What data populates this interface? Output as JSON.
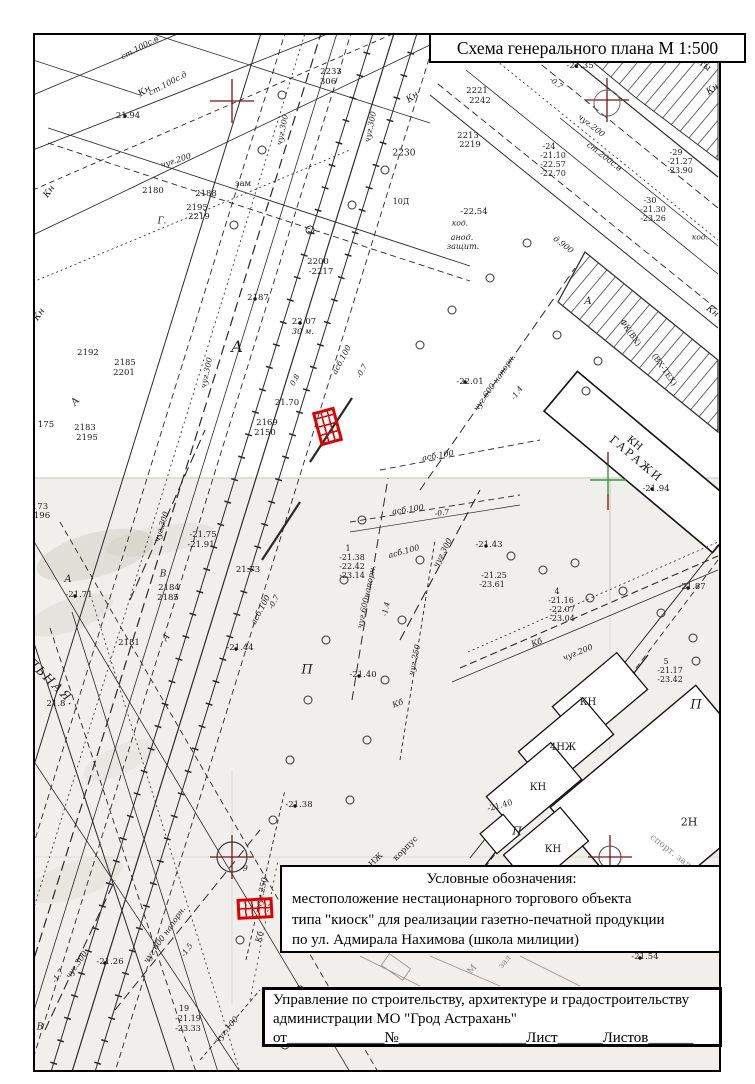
{
  "title_box": {
    "text": "Схема генерального плана М 1:500"
  },
  "legend": {
    "heading": "Условные обозначения:",
    "lines": [
      "местоположение нестационарного торгового объекта",
      "типа \"киоск\" для реализации газетно-печатной продукции",
      "по ул. Адмирала Нахимова (школа милиции)"
    ],
    "symbol": "red-hatched-rectangle"
  },
  "stamp": {
    "line1": "Управление по строительству, архитектуре и градостроительству",
    "line2": "администрации МО \"Грод Астрахань\"",
    "line3": "от_____________№_________________Лист______Листов______"
  },
  "colors": {
    "marker_red": "#e10000",
    "grid_cross_red": "#7d1216",
    "grid_cross_green": "#2f9e38",
    "ink": "#1c1c1c"
  },
  "map": {
    "scale": "М 1:500",
    "labels": [
      [
        "ст.100с.в",
        140,
        48,
        -28,
        8,
        "i"
      ],
      [
        "ст.100с.д",
        168,
        84,
        -28,
        8,
        "i"
      ],
      [
        "Кн",
        145,
        92,
        -32,
        9,
        "i"
      ],
      [
        "21.94",
        128,
        116,
        0,
        8.5,
        ""
      ],
      [
        "чуг.200",
        176,
        161,
        -18,
        8,
        "i"
      ],
      [
        "Кн",
        50,
        192,
        -55,
        9,
        "i"
      ],
      [
        "зам",
        243,
        184,
        0,
        8.5,
        ""
      ],
      [
        "2180",
        153,
        191,
        0,
        8.5,
        ""
      ],
      [
        "2188",
        206,
        194,
        0,
        8.5,
        ""
      ],
      [
        "2195",
        197,
        208,
        0,
        8.5,
        ""
      ],
      [
        "2219",
        199,
        217,
        0,
        8.5,
        ""
      ],
      [
        "Г.",
        162,
        222,
        0,
        9,
        "i"
      ],
      [
        "2192",
        88,
        353,
        0,
        8.5,
        ""
      ],
      [
        "2185",
        125,
        363,
        0,
        8.5,
        ""
      ],
      [
        "2201",
        124,
        373,
        0,
        8.5,
        ""
      ],
      [
        "А",
        76,
        402,
        -50,
        10,
        "i"
      ],
      [
        "чуг.300",
        207,
        373,
        -78,
        8,
        "i"
      ],
      [
        "175",
        46,
        425,
        0,
        8.5,
        ""
      ],
      [
        "2183",
        85,
        428,
        0,
        8.5,
        ""
      ],
      [
        "2195",
        87,
        438,
        0,
        8.5,
        ""
      ],
      [
        "Кн",
        40,
        315,
        -55,
        9,
        "i"
      ],
      [
        "В",
        163,
        575,
        0,
        9,
        "i"
      ],
      [
        "2233",
        331,
        72,
        0,
        8.5,
        ""
      ],
      [
        "306",
        328,
        82,
        0,
        8.5,
        ""
      ],
      [
        "чуг.300",
        283,
        130,
        -78,
        8,
        "i"
      ],
      [
        "чуг.300",
        371,
        127,
        -78,
        8,
        "i"
      ],
      [
        "Кн",
        413,
        98,
        -35,
        9,
        "i"
      ],
      [
        "2221",
        477,
        91,
        0,
        8.5,
        ""
      ],
      [
        "2242",
        480,
        101,
        0,
        8.5,
        ""
      ],
      [
        "2213",
        468,
        136,
        0,
        8.5,
        ""
      ],
      [
        "2219",
        470,
        145,
        0,
        8.5,
        ""
      ],
      [
        "2230",
        404,
        154,
        0,
        9,
        ""
      ],
      [
        "10Д",
        401,
        202,
        0,
        8,
        ""
      ],
      [
        "2200",
        318,
        262,
        0,
        8.5,
        ""
      ],
      [
        "-2217",
        321,
        272,
        0,
        8.5,
        ""
      ],
      [
        "2187",
        258,
        298,
        0,
        8.5,
        ""
      ],
      [
        "22.07",
        304,
        322,
        0,
        8.5,
        ""
      ],
      [
        "30 м.",
        303,
        332,
        0,
        8,
        "i"
      ],
      [
        "А",
        237,
        347,
        0,
        16,
        "i"
      ],
      [
        "0.8",
        295,
        380,
        -62,
        7.5,
        "i"
      ],
      [
        "асб.100",
        342,
        360,
        -62,
        8,
        "i"
      ],
      [
        "-0.7",
        362,
        371,
        -62,
        7.5,
        "i"
      ],
      [
        "21.70",
        287,
        403,
        0,
        8.5,
        ""
      ],
      [
        "2169",
        267,
        423,
        0,
        8.5,
        ""
      ],
      [
        "2150",
        265,
        433,
        0,
        8.5,
        ""
      ],
      [
        "асб.100",
        438,
        456,
        -10,
        8,
        "i"
      ],
      [
        "латы",
        700,
        63,
        38,
        9,
        ""
      ],
      [
        "-21.35",
        580,
        66,
        0,
        8.5,
        ""
      ],
      [
        "-0.7",
        556,
        83,
        38,
        7.5,
        "i"
      ],
      [
        "чуг.200",
        591,
        126,
        38,
        8,
        "i"
      ],
      [
        "ст.200с.в",
        604,
        157,
        38,
        8,
        "i"
      ],
      [
        "-24",
        549,
        147,
        0,
        8,
        ""
      ],
      [
        "-21.10",
        553,
        156,
        0,
        8,
        ""
      ],
      [
        "-22.57",
        553,
        165,
        0,
        8,
        ""
      ],
      [
        "-22.70",
        553,
        174,
        0,
        8,
        ""
      ],
      [
        "-29",
        676,
        153,
        0,
        8,
        ""
      ],
      [
        "-21.27",
        680,
        162,
        0,
        8,
        ""
      ],
      [
        "-23.90",
        680,
        171,
        0,
        8,
        ""
      ],
      [
        "-30",
        650,
        201,
        0,
        8,
        ""
      ],
      [
        "-21.30",
        653,
        210,
        0,
        8,
        ""
      ],
      [
        "-23.26",
        653,
        219,
        0,
        8,
        ""
      ],
      [
        "код.",
        700,
        237,
        0,
        7.5,
        "i"
      ],
      [
        "Кн",
        713,
        90,
        -35,
        9,
        "i"
      ],
      [
        "-22.54",
        474,
        212,
        0,
        8.5,
        ""
      ],
      [
        "код.",
        460,
        223,
        0,
        7.5,
        "i"
      ],
      [
        "анод.",
        462,
        238,
        0,
        8,
        "i"
      ],
      [
        "защит.",
        463,
        247,
        0,
        8,
        "i"
      ],
      [
        "д.900",
        563,
        245,
        38,
        8,
        "i"
      ],
      [
        "А",
        588,
        302,
        0,
        10,
        "i"
      ],
      [
        "Кн",
        712,
        312,
        38,
        9,
        "i"
      ],
      [
        "ФК(ВХ)",
        630,
        333,
        55,
        8,
        ""
      ],
      [
        "(ВХ-ТЕХ)",
        664,
        370,
        55,
        8,
        ""
      ],
      [
        "-22.01",
        470,
        382,
        0,
        8.5,
        ""
      ],
      [
        "чуг.600 напорн.",
        495,
        383,
        -55,
        8,
        "i"
      ],
      [
        "-1.4",
        517,
        393,
        -55,
        7.5,
        "i"
      ],
      [
        "КН",
        634,
        444,
        40,
        10,
        ""
      ],
      [
        "ГАРАЖИ",
        636,
        459,
        40,
        11,
        "ls"
      ],
      [
        "-21.94",
        656,
        489,
        0,
        8.5,
        ""
      ],
      [
        "асб.100",
        408,
        510,
        -8,
        8,
        "i"
      ],
      [
        "-0.7",
        442,
        513,
        -8,
        7.5,
        "i"
      ],
      [
        "173",
        40,
        507,
        0,
        8.5,
        ""
      ],
      [
        "196",
        42,
        516,
        0,
        8.5,
        ""
      ],
      [
        "чуг.300",
        162,
        527,
        -72,
        8,
        "i"
      ],
      [
        "-21.75",
        203,
        535,
        0,
        8.5,
        ""
      ],
      [
        "-21.91",
        201,
        545,
        0,
        8.5,
        ""
      ],
      [
        "21.73",
        248,
        570,
        0,
        8.5,
        ""
      ],
      [
        "А",
        68,
        580,
        0,
        10,
        "i"
      ],
      [
        "-21.71",
        79,
        595,
        0,
        8.5,
        ""
      ],
      [
        "2184",
        169,
        588,
        0,
        8.5,
        ""
      ],
      [
        "2185",
        168,
        598,
        0,
        8.5,
        ""
      ],
      [
        "2181",
        129,
        643,
        0,
        8.5,
        ""
      ],
      [
        "асб.100",
        261,
        610,
        -62,
        8,
        "i"
      ],
      [
        "-0.7",
        274,
        602,
        -62,
        7.5,
        "i"
      ],
      [
        "-21.44",
        240,
        648,
        0,
        8.5,
        ""
      ],
      [
        "А",
        167,
        638,
        -50,
        9,
        "i"
      ],
      [
        "ЛЬНАЯ.",
        52,
        682,
        44,
        12,
        "i ls"
      ],
      [
        "21.8",
        56,
        704,
        0,
        8.5,
        ""
      ],
      [
        "1",
        348,
        549,
        0,
        8,
        ""
      ],
      [
        "-21.38",
        352,
        558,
        0,
        8,
        ""
      ],
      [
        "-22.42",
        352,
        567,
        0,
        8,
        ""
      ],
      [
        "-23.14",
        352,
        576,
        0,
        8,
        ""
      ],
      [
        "асб.100",
        404,
        552,
        -15,
        8,
        "i"
      ],
      [
        "чуг.300",
        443,
        553,
        -62,
        8,
        "i"
      ],
      [
        "-21.43",
        489,
        545,
        0,
        8.5,
        ""
      ],
      [
        "-21.25",
        494,
        576,
        0,
        8,
        ""
      ],
      [
        "-23.61",
        492,
        585,
        0,
        8,
        ""
      ],
      [
        "4",
        557,
        592,
        0,
        8,
        ""
      ],
      [
        "-21.16",
        561,
        601,
        0,
        8,
        ""
      ],
      [
        "-22.07",
        562,
        610,
        0,
        8,
        ""
      ],
      [
        "-23.04",
        562,
        619,
        0,
        8,
        ""
      ],
      [
        "-21.87",
        692,
        587,
        0,
        8.5,
        ""
      ],
      [
        "чуг.600напорн.",
        367,
        597,
        -78,
        8,
        "i"
      ],
      [
        "-1.4",
        386,
        609,
        -78,
        7.5,
        "i"
      ],
      [
        "чуг.250",
        415,
        660,
        -78,
        8,
        "i"
      ],
      [
        "-21.40",
        363,
        675,
        0,
        8.5,
        ""
      ],
      [
        "П",
        307,
        670,
        0,
        13,
        "i"
      ],
      [
        "Кб",
        398,
        704,
        -20,
        8,
        "i"
      ],
      [
        "Кб",
        537,
        643,
        -20,
        8,
        "i"
      ],
      [
        "чуг.200",
        578,
        653,
        -22,
        8,
        "i"
      ],
      [
        "5",
        666,
        662,
        0,
        8,
        ""
      ],
      [
        "-21.17",
        670,
        671,
        0,
        8,
        ""
      ],
      [
        "-23.42",
        670,
        680,
        0,
        8,
        ""
      ],
      [
        "П",
        696,
        705,
        0,
        13,
        "i"
      ],
      [
        "КН",
        588,
        703,
        0,
        10,
        ""
      ],
      [
        "4НЖ",
        563,
        748,
        0,
        10,
        ""
      ],
      [
        "КН",
        538,
        788,
        0,
        10,
        ""
      ],
      [
        "-21.40",
        500,
        806,
        -15,
        8,
        ""
      ],
      [
        "П",
        517,
        831,
        0,
        11,
        "i"
      ],
      [
        "КН",
        553,
        850,
        0,
        10,
        ""
      ],
      [
        "2Н",
        689,
        822,
        0,
        11,
        ""
      ],
      [
        "спорт. зал",
        670,
        852,
        38,
        9,
        "g"
      ],
      [
        "-21.38",
        299,
        805,
        0,
        8.5,
        ""
      ],
      [
        "-9",
        244,
        869,
        0,
        8,
        "i"
      ],
      [
        "НЖ",
        376,
        860,
        -45,
        8,
        ""
      ],
      [
        "корпус",
        406,
        849,
        -45,
        8.5,
        ""
      ],
      [
        "чуг.250",
        262,
        893,
        -78,
        8,
        "i"
      ],
      [
        "Кб",
        260,
        937,
        -78,
        8,
        "i"
      ],
      [
        "чуг.600 напорн.",
        165,
        935,
        -55,
        8,
        "i"
      ],
      [
        "-1.5",
        187,
        950,
        -55,
        7.5,
        "i"
      ],
      [
        "чуг.300",
        77,
        965,
        -55,
        8,
        "i"
      ],
      [
        "-1.7",
        58,
        976,
        -55,
        7.5,
        "i"
      ],
      [
        "-21.26",
        110,
        962,
        0,
        8.5,
        ""
      ],
      [
        "19",
        184,
        1009,
        0,
        8,
        ""
      ],
      [
        "-21.19",
        188,
        1019,
        0,
        8,
        ""
      ],
      [
        "-23.33",
        188,
        1029,
        0,
        8,
        ""
      ],
      [
        "чуг.100",
        227,
        1030,
        -50,
        8,
        "i"
      ],
      [
        "В",
        40,
        1028,
        0,
        9,
        "i"
      ],
      [
        "М",
        473,
        970,
        -50,
        9,
        "g"
      ],
      [
        "зал",
        505,
        962,
        -50,
        8,
        "g"
      ],
      [
        "-21.54",
        645,
        957,
        0,
        8.5,
        ""
      ]
    ]
  }
}
